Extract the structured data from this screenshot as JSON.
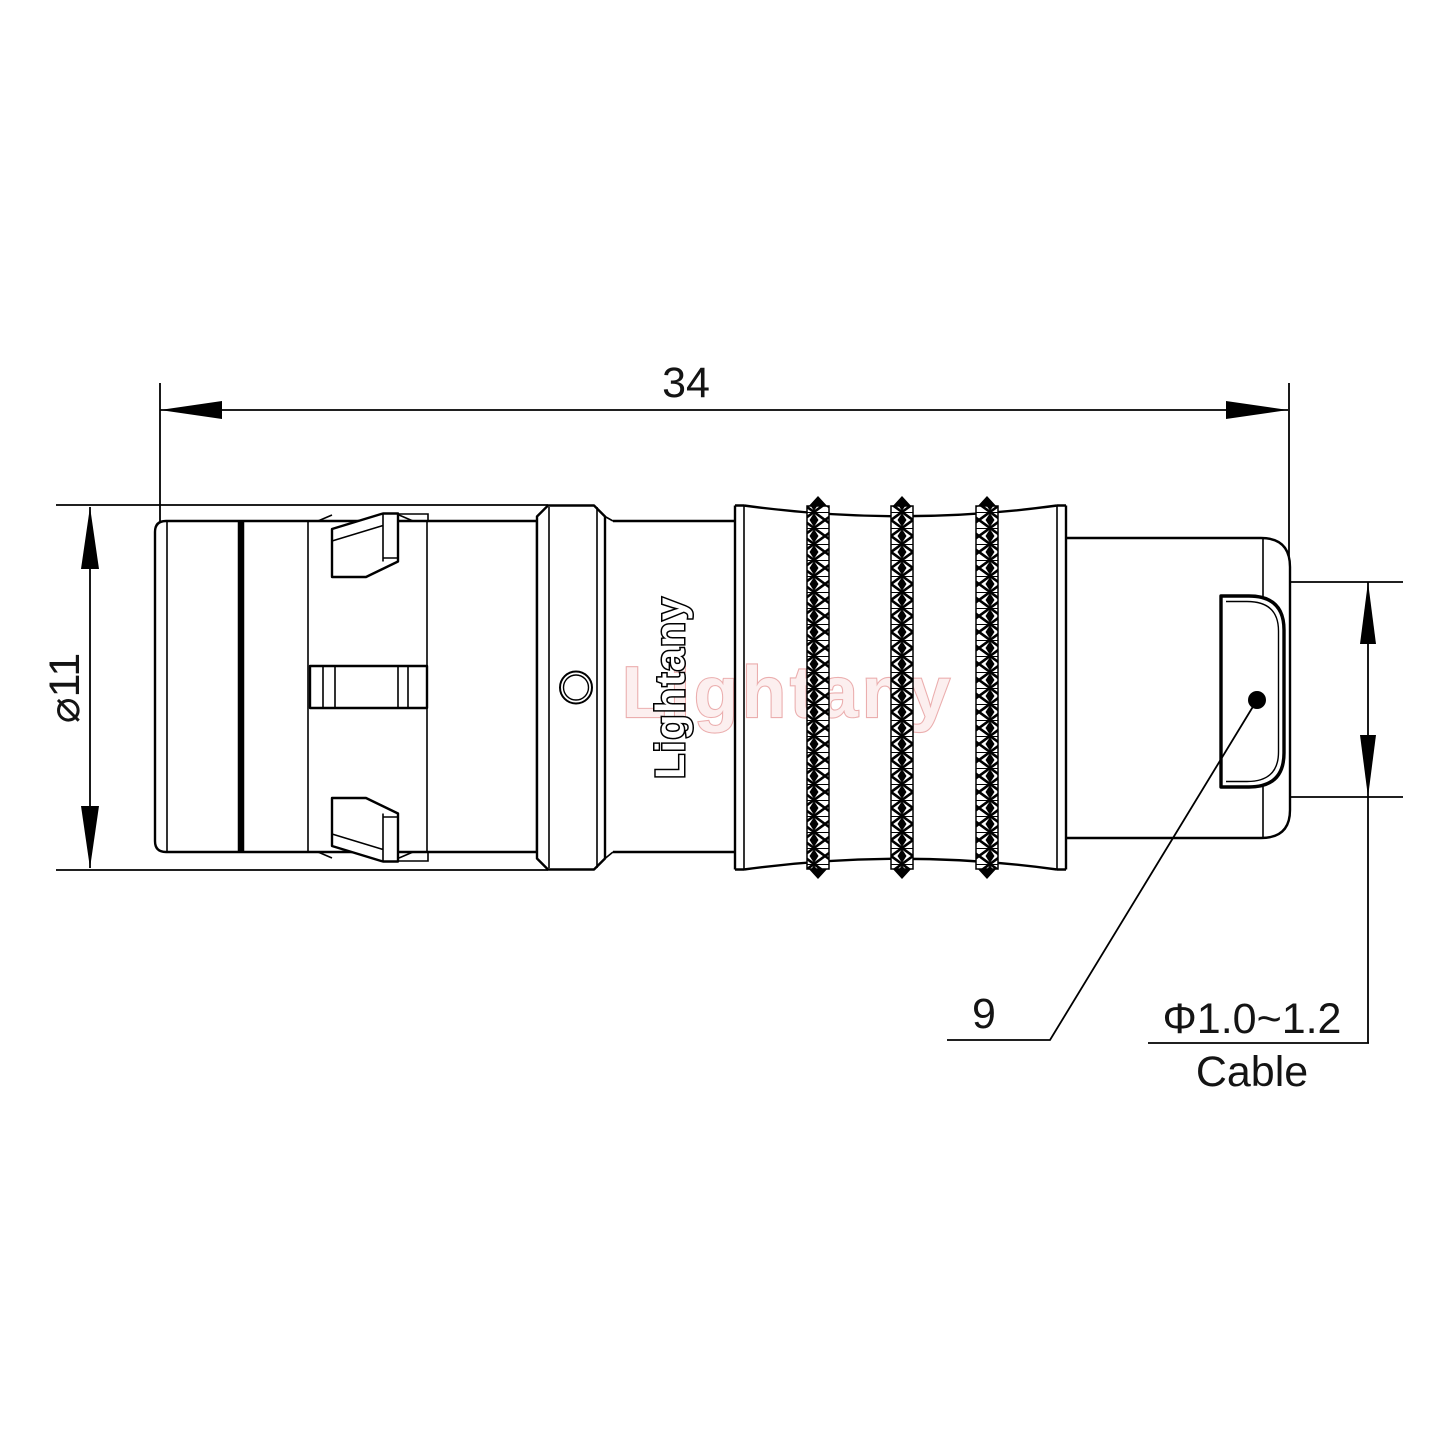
{
  "drawing": {
    "dimensions": {
      "overall_length": "34",
      "body_diameter": "⌀11",
      "rear_ref": "9",
      "cable_spec": "Φ1.0~1.2",
      "cable_word": "Cable"
    },
    "brand": {
      "engraved": "Lightany",
      "watermark": "Lightany"
    },
    "colors": {
      "line": "#000000",
      "background": "#ffffff",
      "watermark_pink": "#e59494"
    }
  }
}
